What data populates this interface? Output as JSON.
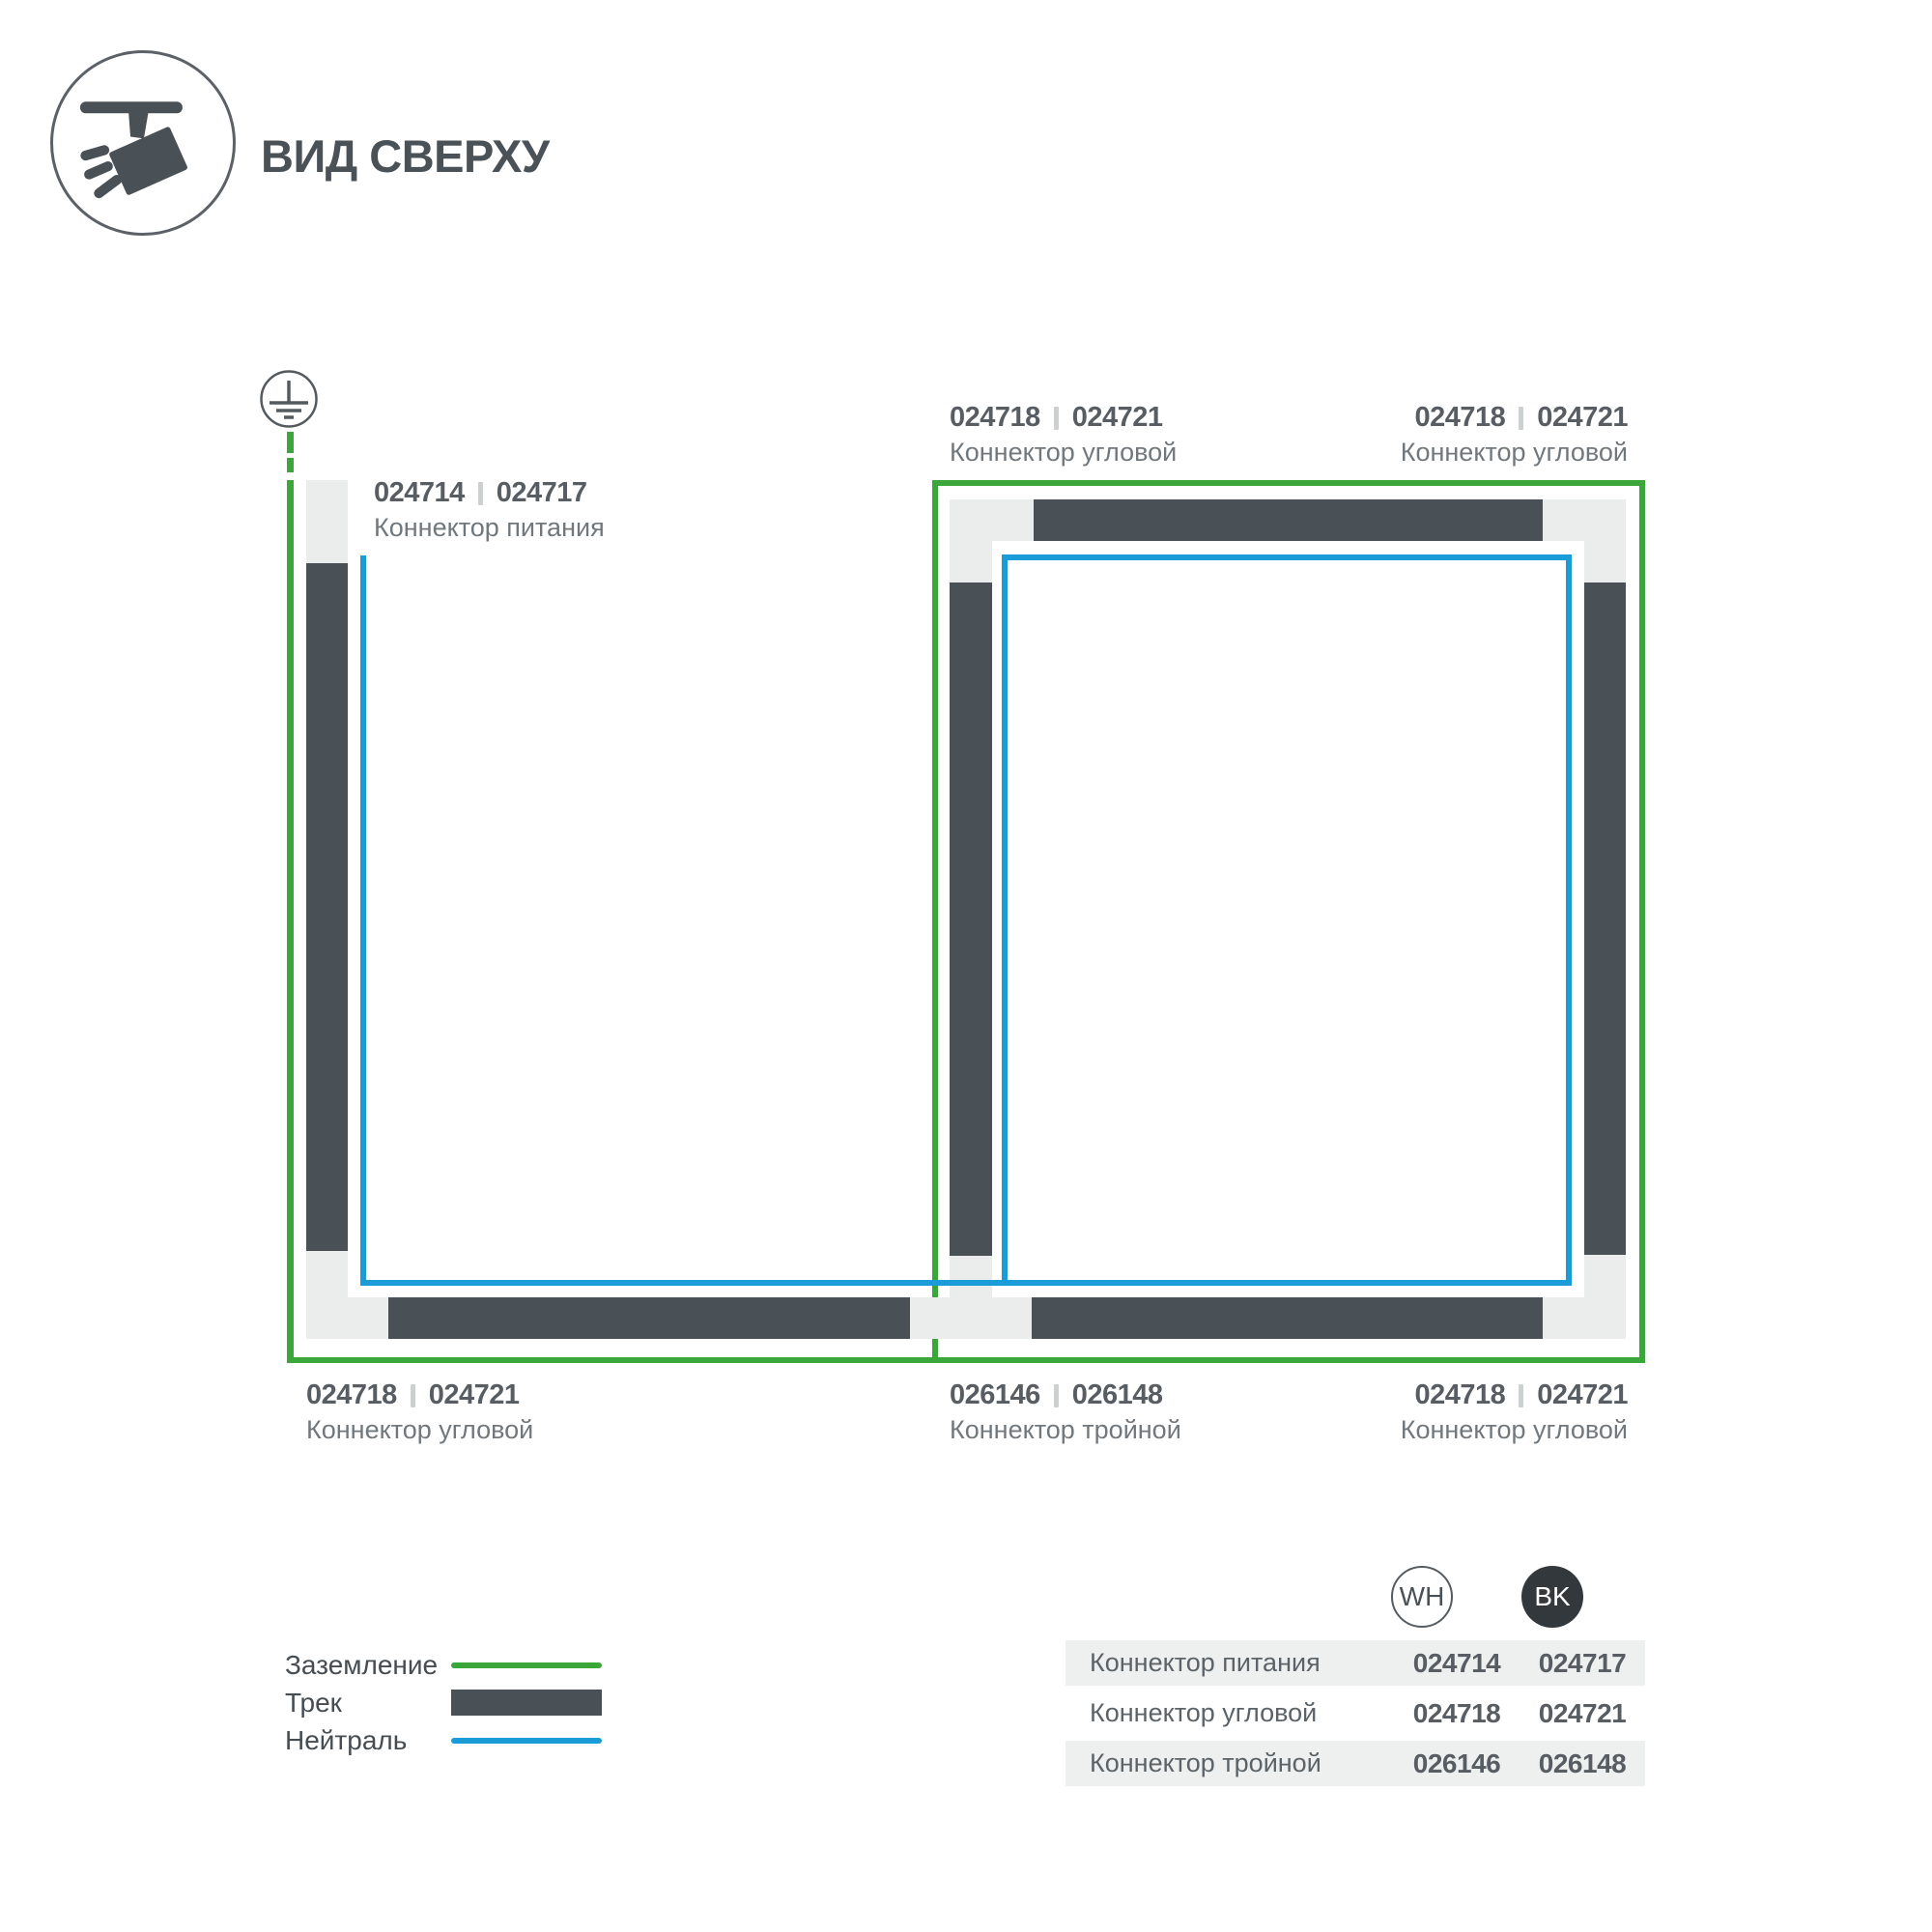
{
  "header": {
    "title": "ВИД СВЕРХУ"
  },
  "icons": {
    "header_icon": "track-spotlight-icon",
    "ground_icon": "ground-earth-icon"
  },
  "colors": {
    "ground_green": "#3ba639",
    "neutral_blue": "#1a9cd8",
    "track_dark": "#4a5156",
    "connector_light": "#ebedec",
    "table_row_bg": "#eef0f0",
    "bk_circle": "#33383c"
  },
  "diagram": {
    "labels": [
      {
        "id": "power",
        "wh": "024714",
        "bk": "024717",
        "name": "Коннектор питания"
      },
      {
        "id": "corner-top-left",
        "wh": "024718",
        "bk": "024721",
        "name": "Коннектор угловой"
      },
      {
        "id": "corner-top-right",
        "wh": "024718",
        "bk": "024721",
        "name": "Коннектор угловой"
      },
      {
        "id": "corner-bottom-left",
        "wh": "024718",
        "bk": "024721",
        "name": "Коннектор угловой"
      },
      {
        "id": "triple",
        "wh": "026146",
        "bk": "026148",
        "name": "Коннектор тройной"
      },
      {
        "id": "corner-bottom-right",
        "wh": "024718",
        "bk": "024721",
        "name": "Коннектор угловой"
      }
    ]
  },
  "legend": {
    "items": [
      {
        "label": "Заземление",
        "swatch": "ground"
      },
      {
        "label": "Трек",
        "swatch": "track"
      },
      {
        "label": "Нейтраль",
        "swatch": "neutral"
      }
    ]
  },
  "table": {
    "columns": [
      {
        "code": "WH"
      },
      {
        "code": "BK"
      }
    ],
    "rows": [
      {
        "name": "Коннектор питания",
        "wh": "024714",
        "bk": "024717"
      },
      {
        "name": "Коннектор угловой",
        "wh": "024718",
        "bk": "024721"
      },
      {
        "name": "Коннектор тройной",
        "wh": "026146",
        "bk": "026148"
      }
    ]
  }
}
